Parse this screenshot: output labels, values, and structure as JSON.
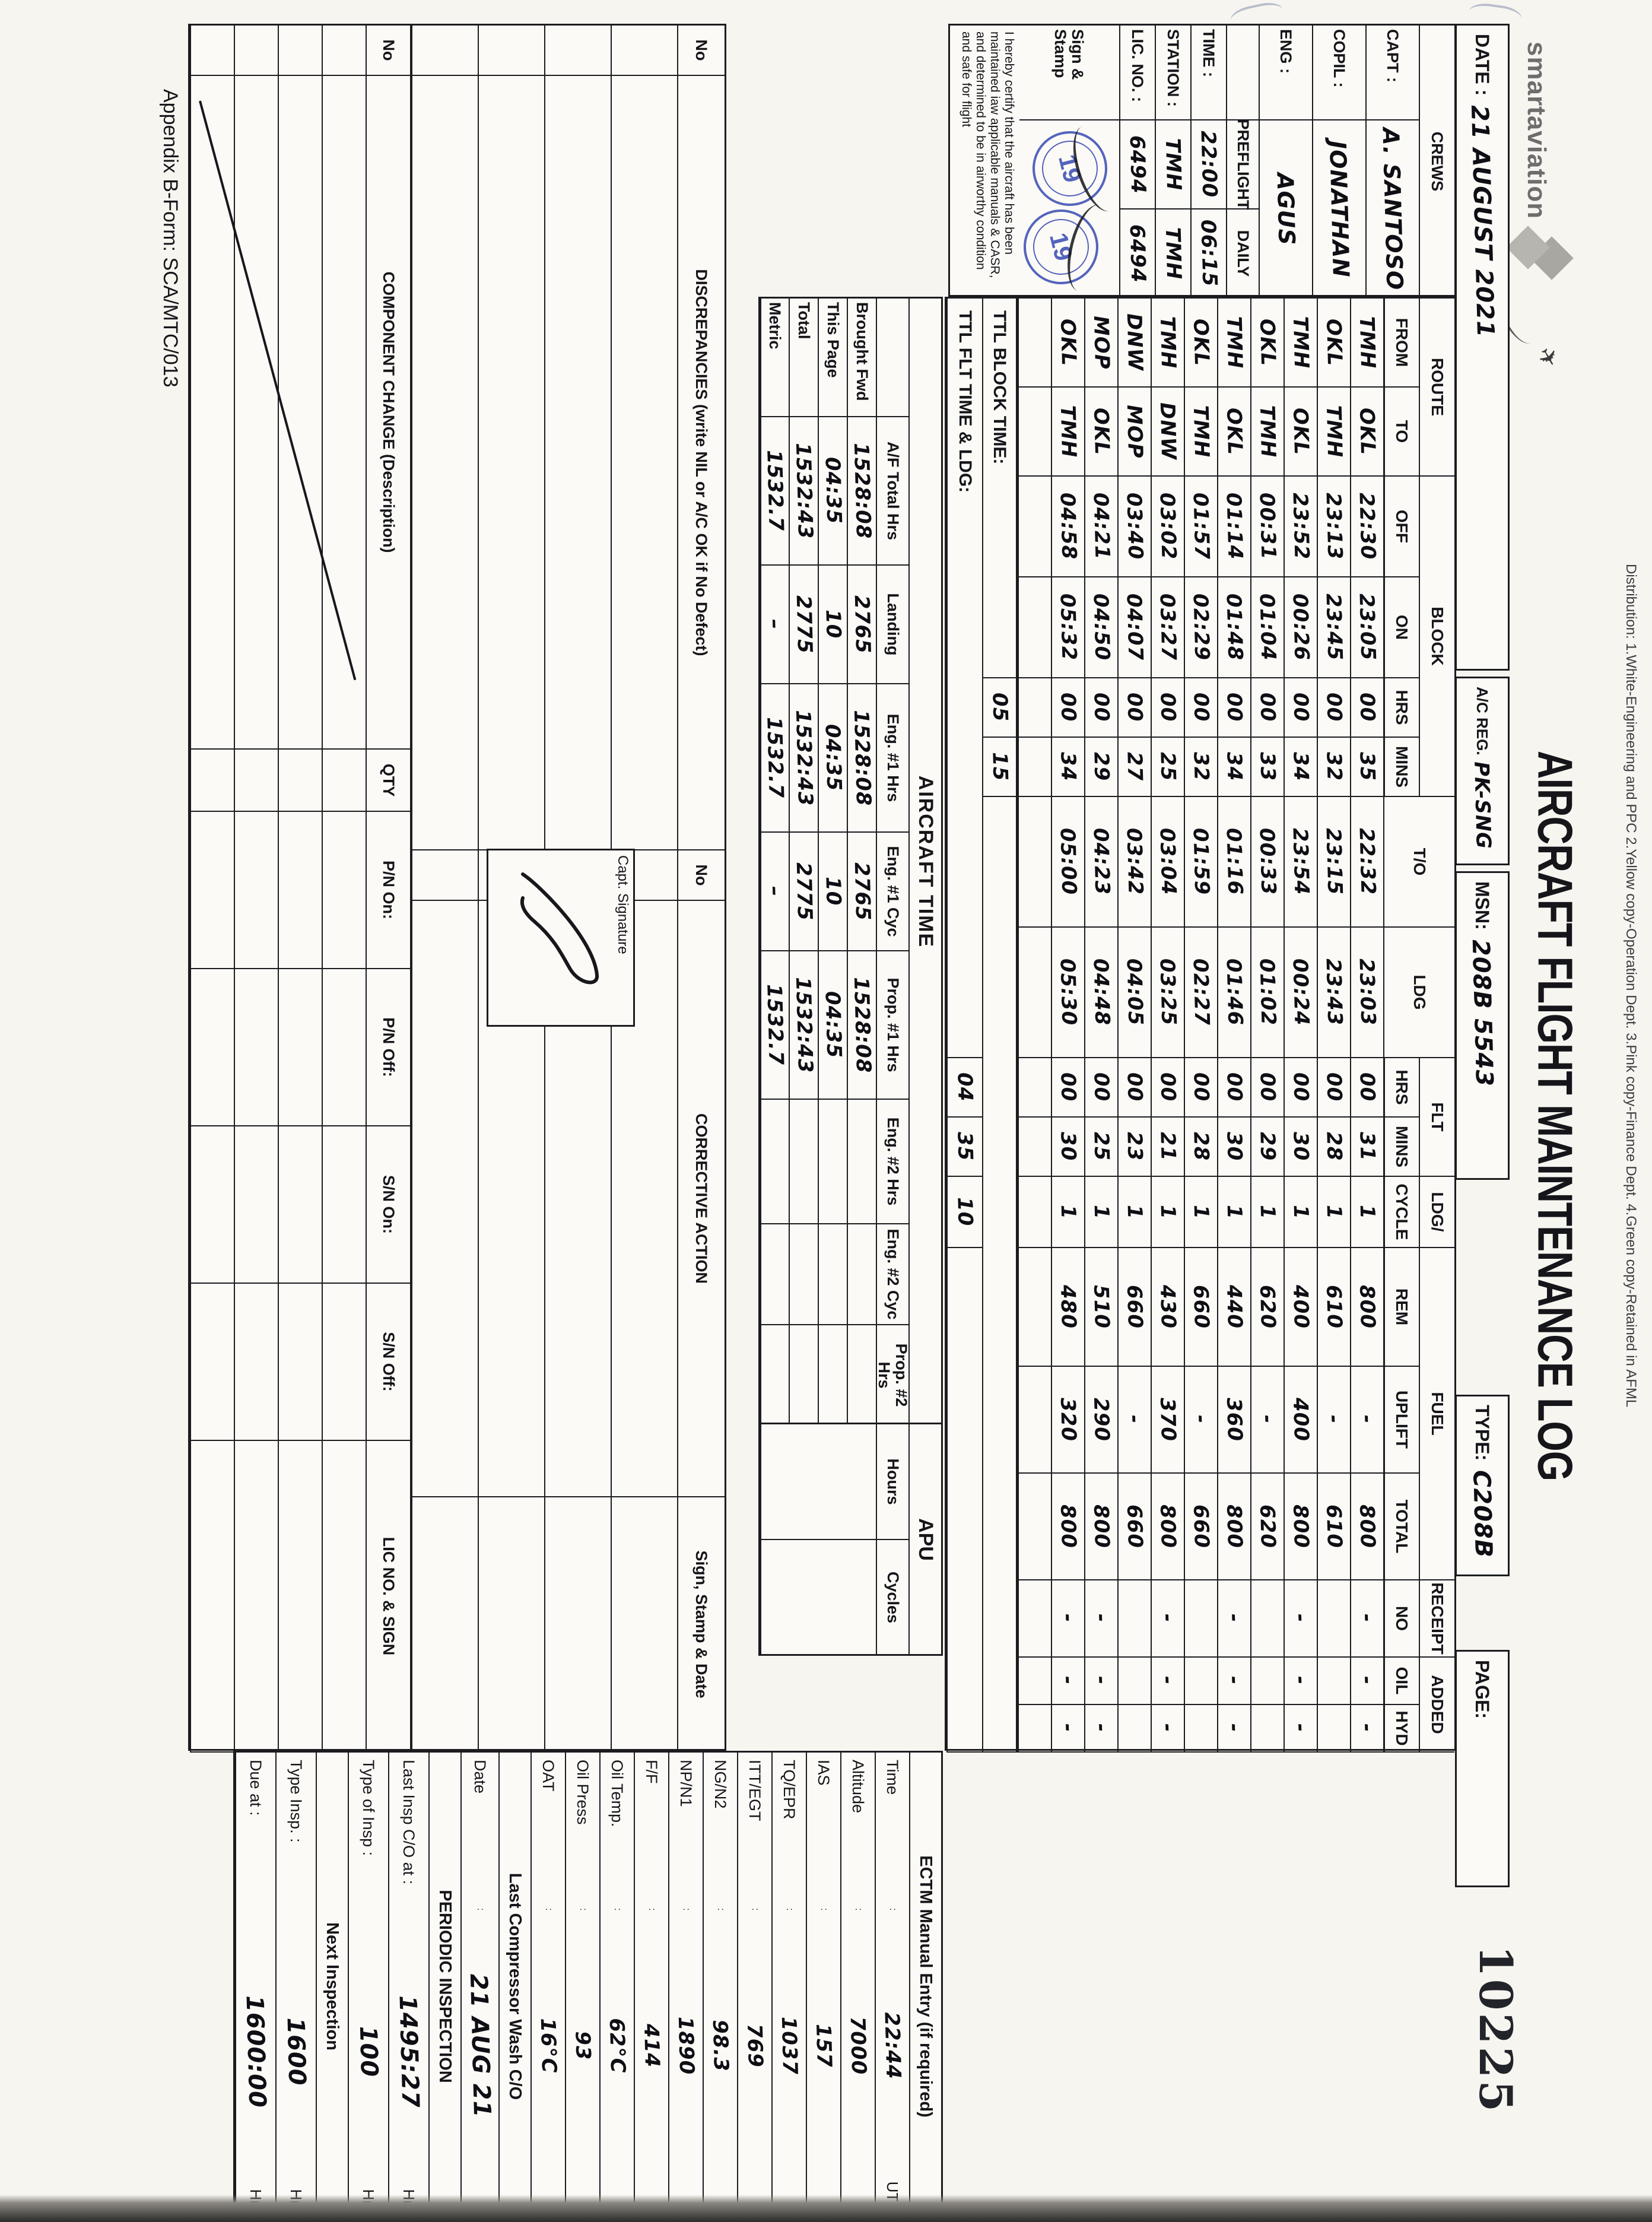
{
  "colors": {
    "ink": "#15151a",
    "stamp_blue": "#2b3fae",
    "paper": "#f7f5f0"
  },
  "scan": {
    "serial": "10225",
    "appendix": "Appendix B-Form: SCA/MTC/013",
    "distribution": "Distribution: 1.White-Engineering and PPC   2.Yellow copy-Operation Dept.   3.Pink copy-Finance Dept.   4.Green copy-Retained in AFML"
  },
  "header": {
    "logo_text": "smartaviation",
    "title": "AIRCRAFT FLIGHT MAINTENANCE LOG",
    "date_label": "DATE :",
    "date_value": "21 AUGUST 2021",
    "reg_label": "A/C REG.",
    "reg_value": "PK-SNG",
    "msn_label": "MSN:",
    "msn_value": "208B 5543",
    "type_label": "TYPE:",
    "type_value": "C208B",
    "page_label": "PAGE:"
  },
  "crews": {
    "title": "CREWS",
    "members": [
      {
        "label": "CAPT :",
        "value": "A. SANTOSO"
      },
      {
        "label": "COPIL :",
        "value": "JONATHAN"
      },
      {
        "label": "ENG :",
        "value": "AGUS"
      }
    ],
    "preflight": "PREFLIGHT",
    "daily": "DAILY",
    "info": [
      {
        "label": "TIME :",
        "pre": "22:00",
        "daily": "06:15"
      },
      {
        "label": "STATION :",
        "pre": "TMH",
        "daily": "TMH"
      },
      {
        "label": "LIC. NO. :",
        "pre": "6494",
        "daily": "6494"
      }
    ],
    "sign_label": "Sign & Stamp",
    "stamp_text": "19"
  },
  "certification": "I hereby certify that the aircraft has been maintained iaw applicable manuals & CASR, and determined to be in airworthy condition and safe for flight",
  "flight_table": {
    "groups": {
      "route": "ROUTE",
      "block": "BLOCK",
      "flt": "FLT",
      "ldg_slash": "LDG/",
      "fuel": "FUEL",
      "receipt": "RECEIPT",
      "added": "ADDED"
    },
    "cols": {
      "from": "FROM",
      "to": "TO",
      "off": "OFF",
      "on": "ON",
      "hrs": "HRS",
      "mins": "MINS",
      "to_time": "T/O",
      "ldg": "LDG",
      "fhrs": "HRS",
      "fmins": "MINS",
      "cycle": "CYCLE",
      "rem": "REM",
      "uplift": "UPLIFT",
      "total": "TOTAL",
      "no": "NO",
      "oil": "OIL",
      "hyd": "HYD"
    },
    "rows": [
      {
        "from": "TMH",
        "to": "OKL",
        "off": "22:30",
        "on": "23:05",
        "bh": "00",
        "bm": "35",
        "tof": "22:32",
        "ldg": "23:03",
        "fh": "00",
        "fm": "31",
        "cyc": "1",
        "rem": "800",
        "up": "-",
        "tot": "800",
        "no": "-",
        "oil": "-",
        "hyd": "-"
      },
      {
        "from": "OKL",
        "to": "TMH",
        "off": "23:13",
        "on": "23:45",
        "bh": "00",
        "bm": "32",
        "tof": "23:15",
        "ldg": "23:43",
        "fh": "00",
        "fm": "28",
        "cyc": "1",
        "rem": "610",
        "up": "-",
        "tot": "610",
        "no": "",
        "oil": "",
        "hyd": ""
      },
      {
        "from": "TMH",
        "to": "OKL",
        "off": "23:52",
        "on": "00:26",
        "bh": "00",
        "bm": "34",
        "tof": "23:54",
        "ldg": "00:24",
        "fh": "00",
        "fm": "30",
        "cyc": "1",
        "rem": "400",
        "up": "400",
        "tot": "800",
        "no": "-",
        "oil": "-",
        "hyd": "-"
      },
      {
        "from": "OKL",
        "to": "TMH",
        "off": "00:31",
        "on": "01:04",
        "bh": "00",
        "bm": "33",
        "tof": "00:33",
        "ldg": "01:02",
        "fh": "00",
        "fm": "29",
        "cyc": "1",
        "rem": "620",
        "up": "-",
        "tot": "620",
        "no": "",
        "oil": "",
        "hyd": ""
      },
      {
        "from": "TMH",
        "to": "OKL",
        "off": "01:14",
        "on": "01:48",
        "bh": "00",
        "bm": "34",
        "tof": "01:16",
        "ldg": "01:46",
        "fh": "00",
        "fm": "30",
        "cyc": "1",
        "rem": "440",
        "up": "360",
        "tot": "800",
        "no": "-",
        "oil": "-",
        "hyd": "-"
      },
      {
        "from": "OKL",
        "to": "TMH",
        "off": "01:57",
        "on": "02:29",
        "bh": "00",
        "bm": "32",
        "tof": "01:59",
        "ldg": "02:27",
        "fh": "00",
        "fm": "28",
        "cyc": "1",
        "rem": "660",
        "up": "-",
        "tot": "660",
        "no": "",
        "oil": "",
        "hyd": ""
      },
      {
        "from": "TMH",
        "to": "DNW",
        "off": "03:02",
        "on": "03:27",
        "bh": "00",
        "bm": "25",
        "tof": "03:04",
        "ldg": "03:25",
        "fh": "00",
        "fm": "21",
        "cyc": "1",
        "rem": "430",
        "up": "370",
        "tot": "800",
        "no": "-",
        "oil": "-",
        "hyd": "-"
      },
      {
        "from": "DNW",
        "to": "MOP",
        "off": "03:40",
        "on": "04:07",
        "bh": "00",
        "bm": "27",
        "tof": "03:42",
        "ldg": "04:05",
        "fh": "00",
        "fm": "23",
        "cyc": "1",
        "rem": "660",
        "up": "-",
        "tot": "660",
        "no": "",
        "oil": "",
        "hyd": ""
      },
      {
        "from": "MOP",
        "to": "OKL",
        "off": "04:21",
        "on": "04:50",
        "bh": "00",
        "bm": "29",
        "tof": "04:23",
        "ldg": "04:48",
        "fh": "00",
        "fm": "25",
        "cyc": "1",
        "rem": "510",
        "up": "290",
        "tot": "800",
        "no": "-",
        "oil": "-",
        "hyd": "-"
      },
      {
        "from": "OKL",
        "to": "TMH",
        "off": "04:58",
        "on": "05:32",
        "bh": "00",
        "bm": "34",
        "tof": "05:00",
        "ldg": "05:30",
        "fh": "00",
        "fm": "30",
        "cyc": "1",
        "rem": "480",
        "up": "320",
        "tot": "800",
        "no": "-",
        "oil": "-",
        "hyd": "-"
      },
      {
        "from": "",
        "to": "",
        "off": "",
        "on": "",
        "bh": "",
        "bm": "",
        "tof": "",
        "ldg": "",
        "fh": "",
        "fm": "",
        "cyc": "",
        "rem": "",
        "up": "",
        "tot": "",
        "no": "",
        "oil": "",
        "hyd": ""
      }
    ],
    "ttl_block": {
      "label": "TTL BLOCK TIME:",
      "hrs": "05",
      "mins": "15"
    },
    "ttl_flt": {
      "label": "TTL FLT TIME & LDG:",
      "hrs": "04",
      "mins": "35",
      "ldg": "10"
    }
  },
  "aircraft_time": {
    "title": "AIRCRAFT TIME",
    "cols": [
      "A/F Total Hrs",
      "Landing",
      "Eng. #1 Hrs",
      "Eng. #1 Cyc",
      "Prop. #1 Hrs",
      "Eng. #2 Hrs",
      "Eng. #2 Cyc",
      "Prop. #2 Hrs"
    ],
    "rows": [
      {
        "label": "Brought Fwd",
        "af": "1528:08",
        "ldg": "2765",
        "e1h": "1528:08",
        "e1c": "2765",
        "p1h": "1528:08",
        "e2h": "",
        "e2c": "",
        "p2h": ""
      },
      {
        "label": "This Page",
        "af": "04:35",
        "ldg": "10",
        "e1h": "04:35",
        "e1c": "10",
        "p1h": "04:35",
        "e2h": "",
        "e2c": "",
        "p2h": ""
      },
      {
        "label": "Total",
        "af": "1532:43",
        "ldg": "2775",
        "e1h": "1532:43",
        "e1c": "2775",
        "p1h": "1532:43",
        "e2h": "",
        "e2c": "",
        "p2h": ""
      },
      {
        "label": "Metric",
        "af": "1532.7",
        "ldg": "–",
        "e1h": "1532.7",
        "e1c": "–",
        "p1h": "1532.7",
        "e2h": "",
        "e2c": "",
        "p2h": ""
      }
    ]
  },
  "apu": {
    "title": "APU",
    "hours_label": "Hours",
    "cycles_label": "Cycles",
    "hours_value": "",
    "cycles_value": ""
  },
  "ectm": {
    "title": "ECTM Manual Entry (if required)",
    "rows": [
      {
        "label": "Time",
        "value": "22:44",
        "suffix": "UTC"
      },
      {
        "label": "Altitude",
        "value": "7000",
        "suffix": ""
      },
      {
        "label": "IAS",
        "value": "157",
        "suffix": ""
      },
      {
        "label": "TQ/EPR",
        "value": "1037",
        "suffix": ""
      },
      {
        "label": "ITT/EGT",
        "value": "769",
        "suffix": ""
      },
      {
        "label": "NG/N2",
        "value": "98.3",
        "suffix": ""
      },
      {
        "label": "NP/N1",
        "value": "1890",
        "suffix": ""
      },
      {
        "label": "F/F",
        "value": "414",
        "suffix": ""
      },
      {
        "label": "Oil Temp.",
        "value": "62°C",
        "suffix": ""
      },
      {
        "label": "Oil Press",
        "value": "93",
        "suffix": ""
      },
      {
        "label": "OAT",
        "value": "16°C",
        "suffix": ""
      }
    ]
  },
  "compressor_wash": {
    "title": "Last Compressor Wash C/O",
    "date_label": "Date",
    "date_value": "21 AUG 21"
  },
  "periodic": {
    "title": "PERIODIC INSPECTION",
    "rows": [
      {
        "label": "Last Insp C/O at :",
        "value": "1495:27",
        "unit": "Hrs"
      },
      {
        "label": "Type of Insp :",
        "value": "100",
        "unit": "Hrs"
      }
    ],
    "next_title": "Next Inspection",
    "next_rows": [
      {
        "label": "Type Insp. :",
        "value": "1600",
        "unit": "Hrs"
      },
      {
        "label": "Due at :",
        "value": "1600:00",
        "unit": "Hrs"
      }
    ]
  },
  "discrepancies": {
    "col_no": "No",
    "col_desc": "DISCREPANCIES (write NIL or A/C OK if No Defect)",
    "col_no2": "No",
    "col_action": "CORRECTIVE ACTION",
    "col_sign": "Sign, Stamp & Date",
    "capt_sig_label": "Capt. Signature"
  },
  "component_change": {
    "col_no": "No",
    "col_desc": "COMPONENT CHANGE (Description)",
    "col_qty": "QTY",
    "col_pn_on": "P/N On:",
    "col_pn_off": "P/N Off:",
    "col_sn_on": "S/N On:",
    "col_sn_off": "S/N Off:",
    "col_lic": "LIC NO. & SIGN"
  }
}
